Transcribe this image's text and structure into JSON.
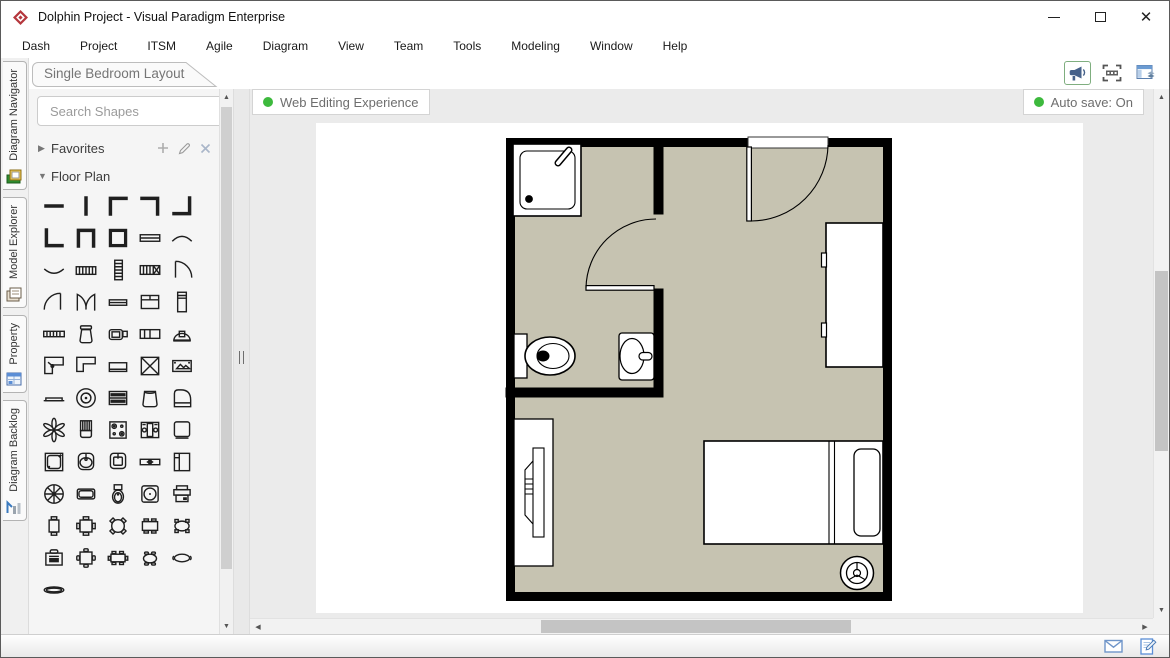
{
  "window": {
    "title": "Dolphin Project - Visual Paradigm Enterprise",
    "logo": "visual-paradigm-logo",
    "controls": [
      "minimize",
      "maximize",
      "close"
    ]
  },
  "menu": {
    "items": [
      "Dash",
      "Project",
      "ITSM",
      "Agile",
      "Diagram",
      "View",
      "Team",
      "Tools",
      "Modeling",
      "Window",
      "Help"
    ]
  },
  "diagram_tab": {
    "label": "Single Bedroom Layout"
  },
  "header_toolbar": {
    "icons": [
      "announcement-icon",
      "fit-selection-icon",
      "layout-panels-icon"
    ]
  },
  "side_tabs": {
    "items": [
      {
        "label": "Diagram Navigator",
        "icon": "diagram-navigator-icon"
      },
      {
        "label": "Model Explorer",
        "icon": "model-explorer-icon"
      },
      {
        "label": "Property",
        "icon": "property-icon"
      },
      {
        "label": "Diagram Backlog",
        "icon": "diagram-backlog-icon"
      }
    ]
  },
  "palette": {
    "search": {
      "placeholder": "Search Shapes",
      "icon": "search-icon",
      "menu_icon": "kebab-menu-icon"
    },
    "sections": [
      {
        "label": "Favorites",
        "state": "collapsed",
        "actions": [
          "add-icon",
          "edit-icon",
          "delete-icon"
        ]
      },
      {
        "label": "Floor Plan",
        "state": "expanded"
      }
    ],
    "shapes": [
      "wall-horizontal",
      "wall-vertical",
      "wall-corner-top-left",
      "wall-corner-top-right",
      "wall-corner-bottom-right",
      "wall-corner-bottom-left",
      "wall-u-shape",
      "room-square",
      "window",
      "curved-wall-up",
      "curved-wall-down",
      "stairs-horizontal",
      "stairs-vertical",
      "stairs-with-landing",
      "door-quarter-right",
      "door-quarter-left",
      "double-door",
      "sliding-window",
      "counter-with-sink",
      "tall-cabinet",
      "piano-keyboard",
      "water-heater",
      "tv-with-console",
      "double-window-seat",
      "wall-lamp",
      "corner-desk-left",
      "corner-desk-right",
      "sideboard",
      "elevator",
      "picture-frame",
      "low-shelf",
      "ceiling-fan",
      "chest-of-drawers",
      "laundry-basket",
      "grand-piano",
      "plant",
      "high-back-chair",
      "stove-top",
      "washing-machine",
      "small-appliance",
      "shower-stall",
      "oval-sink",
      "square-sink",
      "window-bench",
      "refrigerator",
      "spoked-wheel-table",
      "bathtub",
      "toilet",
      "round-side-table",
      "printer",
      "table-two-chairs",
      "square-table-four-chairs",
      "round-table-four-chairs",
      "rect-table-four-chairs",
      "oval-table-four-chairs",
      "office-desk-chair",
      "square-table-four-chairs-alt",
      "rect-table-six-chairs",
      "oval-table-four-chairs-alt",
      "oval-table-two-chairs",
      "oval-rug"
    ]
  },
  "canvas": {
    "badges": [
      {
        "label": "Web Editing Experience",
        "dot_color": "#3db93d"
      },
      {
        "label": "Auto save: On",
        "dot_color": "#3db93d"
      }
    ],
    "floor_plan": {
      "floor_color": "#c6c3b1",
      "wall_color": "#000000",
      "rooms": [
        "bathroom",
        "bedroom"
      ],
      "items": [
        "shower",
        "toilet",
        "sink",
        "bathroom-door",
        "entrance-door",
        "wardrobe",
        "bed",
        "pillow",
        "desk-with-chair",
        "fan"
      ]
    }
  },
  "status_bar": {
    "icons": [
      "mail-icon",
      "edit-diagram-icon"
    ]
  },
  "colors": {
    "canvas_bg": "#ebebeb",
    "panel_bg": "#f5f5f5",
    "badge_text": "#6e6e6e",
    "accent_green": "#3db93d"
  }
}
